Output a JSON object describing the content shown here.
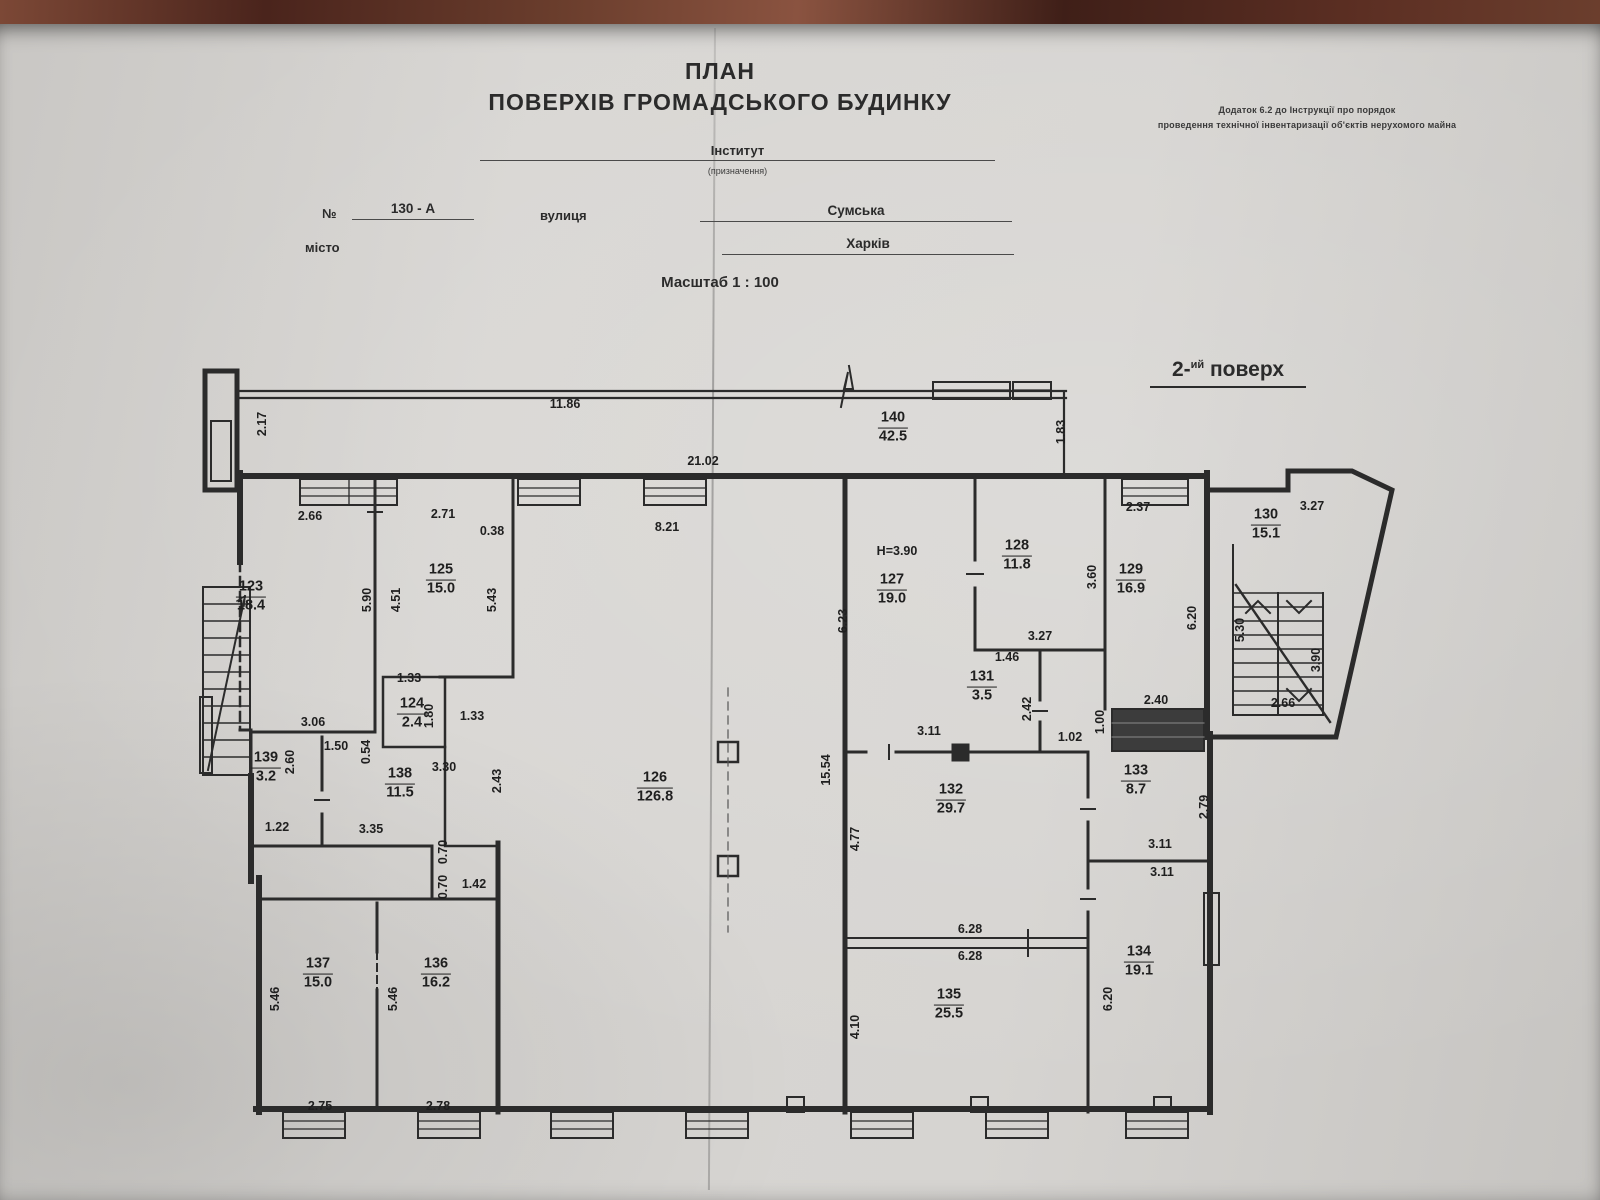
{
  "header": {
    "title_line1": "ПЛАН",
    "title_line2": "ПОВЕРХІВ ГРОМАДСЬКОГО БУДИНКУ",
    "appendix_line1": "Додаток 6.2 до Інструкції про порядок",
    "appendix_line2": "проведення технічної інвентаризації об'єктів нерухомого майна",
    "purpose_value": "Інститут",
    "purpose_caption": "(призначення)",
    "number_label": "№",
    "number_value": "130 - А",
    "street_label": "вулиця",
    "street_value": "Сумська",
    "city_label": "місто",
    "city_value": "Харків",
    "scale_text": "Масштаб 1 : 100",
    "floor_prefix": "2-",
    "floor_sup": "ий",
    "floor_suffix": " поверх"
  },
  "plan": {
    "ink_color": "#2b2b2b",
    "paper_color": "#d6d4d1",
    "rooms": [
      {
        "number": "140",
        "area": "42.5",
        "x": 893,
        "y": 428
      },
      {
        "number": "123",
        "area": "18.4",
        "x": 251,
        "y": 597
      },
      {
        "number": "125",
        "area": "15.0",
        "x": 441,
        "y": 580
      },
      {
        "number": "124",
        "area": "2.4",
        "x": 412,
        "y": 714
      },
      {
        "number": "139",
        "area": "3.2",
        "x": 266,
        "y": 768
      },
      {
        "number": "138",
        "area": "11.5",
        "x": 400,
        "y": 784
      },
      {
        "number": "126",
        "area": "126.8",
        "x": 655,
        "y": 788
      },
      {
        "number": "127",
        "area": "19.0",
        "x": 892,
        "y": 590
      },
      {
        "number": "128",
        "area": "11.8",
        "x": 1017,
        "y": 556
      },
      {
        "number": "129",
        "area": "16.9",
        "x": 1131,
        "y": 580
      },
      {
        "number": "130",
        "area": "15.1",
        "x": 1266,
        "y": 525
      },
      {
        "number": "131",
        "area": "3.5",
        "x": 982,
        "y": 687
      },
      {
        "number": "132",
        "area": "29.7",
        "x": 951,
        "y": 800
      },
      {
        "number": "133",
        "area": "8.7",
        "x": 1136,
        "y": 781
      },
      {
        "number": "134",
        "area": "19.1",
        "x": 1139,
        "y": 962
      },
      {
        "number": "135",
        "area": "25.5",
        "x": 949,
        "y": 1005
      },
      {
        "number": "136",
        "area": "16.2",
        "x": 436,
        "y": 974
      },
      {
        "number": "137",
        "area": "15.0",
        "x": 318,
        "y": 974
      }
    ],
    "dims": [
      {
        "value": "2.17",
        "x": 262,
        "y": 424,
        "vertical": true
      },
      {
        "value": "11.86",
        "x": 565,
        "y": 404
      },
      {
        "value": "1.83",
        "x": 1061,
        "y": 432,
        "vertical": true
      },
      {
        "value": "21.02",
        "x": 703,
        "y": 461
      },
      {
        "value": "2.66",
        "x": 310,
        "y": 516
      },
      {
        "value": "2.71",
        "x": 443,
        "y": 514
      },
      {
        "value": "0.38",
        "x": 492,
        "y": 531
      },
      {
        "value": "8.21",
        "x": 667,
        "y": 527
      },
      {
        "value": "2.37",
        "x": 1138,
        "y": 507
      },
      {
        "value": "3.27",
        "x": 1312,
        "y": 506
      },
      {
        "value": "5.90",
        "x": 367,
        "y": 600,
        "vertical": true
      },
      {
        "value": "4.51",
        "x": 396,
        "y": 600,
        "vertical": true
      },
      {
        "value": "5.43",
        "x": 492,
        "y": 600,
        "vertical": true
      },
      {
        "value": "6.23",
        "x": 843,
        "y": 621,
        "vertical": true
      },
      {
        "value": "Н=3.90",
        "x": 897,
        "y": 551
      },
      {
        "value": "3.60",
        "x": 1092,
        "y": 577,
        "vertical": true
      },
      {
        "value": "6.20",
        "x": 1192,
        "y": 618,
        "vertical": true
      },
      {
        "value": "5.30",
        "x": 1240,
        "y": 630,
        "vertical": true
      },
      {
        "value": "3.90",
        "x": 1316,
        "y": 660,
        "vertical": true
      },
      {
        "value": "2.66",
        "x": 1283,
        "y": 703
      },
      {
        "value": "1.33",
        "x": 409,
        "y": 678
      },
      {
        "value": "1.80",
        "x": 429,
        "y": 716,
        "vertical": true
      },
      {
        "value": "1.33",
        "x": 472,
        "y": 716
      },
      {
        "value": "3.06",
        "x": 313,
        "y": 722
      },
      {
        "value": "1.50",
        "x": 336,
        "y": 746
      },
      {
        "value": "0.54",
        "x": 366,
        "y": 752,
        "vertical": true
      },
      {
        "value": "3.30",
        "x": 444,
        "y": 767
      },
      {
        "value": "2.60",
        "x": 290,
        "y": 762,
        "vertical": true
      },
      {
        "value": "2.43",
        "x": 497,
        "y": 781,
        "vertical": true
      },
      {
        "value": "1.46",
        "x": 1007,
        "y": 657
      },
      {
        "value": "3.27",
        "x": 1040,
        "y": 636
      },
      {
        "value": "2.42",
        "x": 1027,
        "y": 709,
        "vertical": true
      },
      {
        "value": "3.11",
        "x": 929,
        "y": 731
      },
      {
        "value": "1.02",
        "x": 1070,
        "y": 737
      },
      {
        "value": "1.00",
        "x": 1100,
        "y": 722,
        "vertical": true
      },
      {
        "value": "2.40",
        "x": 1156,
        "y": 700
      },
      {
        "value": "15.54",
        "x": 826,
        "y": 770,
        "vertical": true
      },
      {
        "value": "4.77",
        "x": 855,
        "y": 839,
        "vertical": true
      },
      {
        "value": "1.22",
        "x": 277,
        "y": 827
      },
      {
        "value": "3.35",
        "x": 371,
        "y": 829
      },
      {
        "value": "0.70",
        "x": 443,
        "y": 852,
        "vertical": true
      },
      {
        "value": "0.70",
        "x": 443,
        "y": 887,
        "vertical": true
      },
      {
        "value": "1.42",
        "x": 474,
        "y": 884
      },
      {
        "value": "2.79",
        "x": 1204,
        "y": 807,
        "vertical": true
      },
      {
        "value": "3.11",
        "x": 1160,
        "y": 844
      },
      {
        "value": "3.11",
        "x": 1162,
        "y": 872
      },
      {
        "value": "6.28",
        "x": 970,
        "y": 929
      },
      {
        "value": "6.28",
        "x": 970,
        "y": 956
      },
      {
        "value": "4.10",
        "x": 855,
        "y": 1027,
        "vertical": true
      },
      {
        "value": "6.20",
        "x": 1108,
        "y": 999,
        "vertical": true
      },
      {
        "value": "5.46",
        "x": 275,
        "y": 999,
        "vertical": true
      },
      {
        "value": "5.46",
        "x": 393,
        "y": 999,
        "vertical": true
      },
      {
        "value": "2.75",
        "x": 320,
        "y": 1106
      },
      {
        "value": "2.78",
        "x": 438,
        "y": 1106
      }
    ]
  }
}
